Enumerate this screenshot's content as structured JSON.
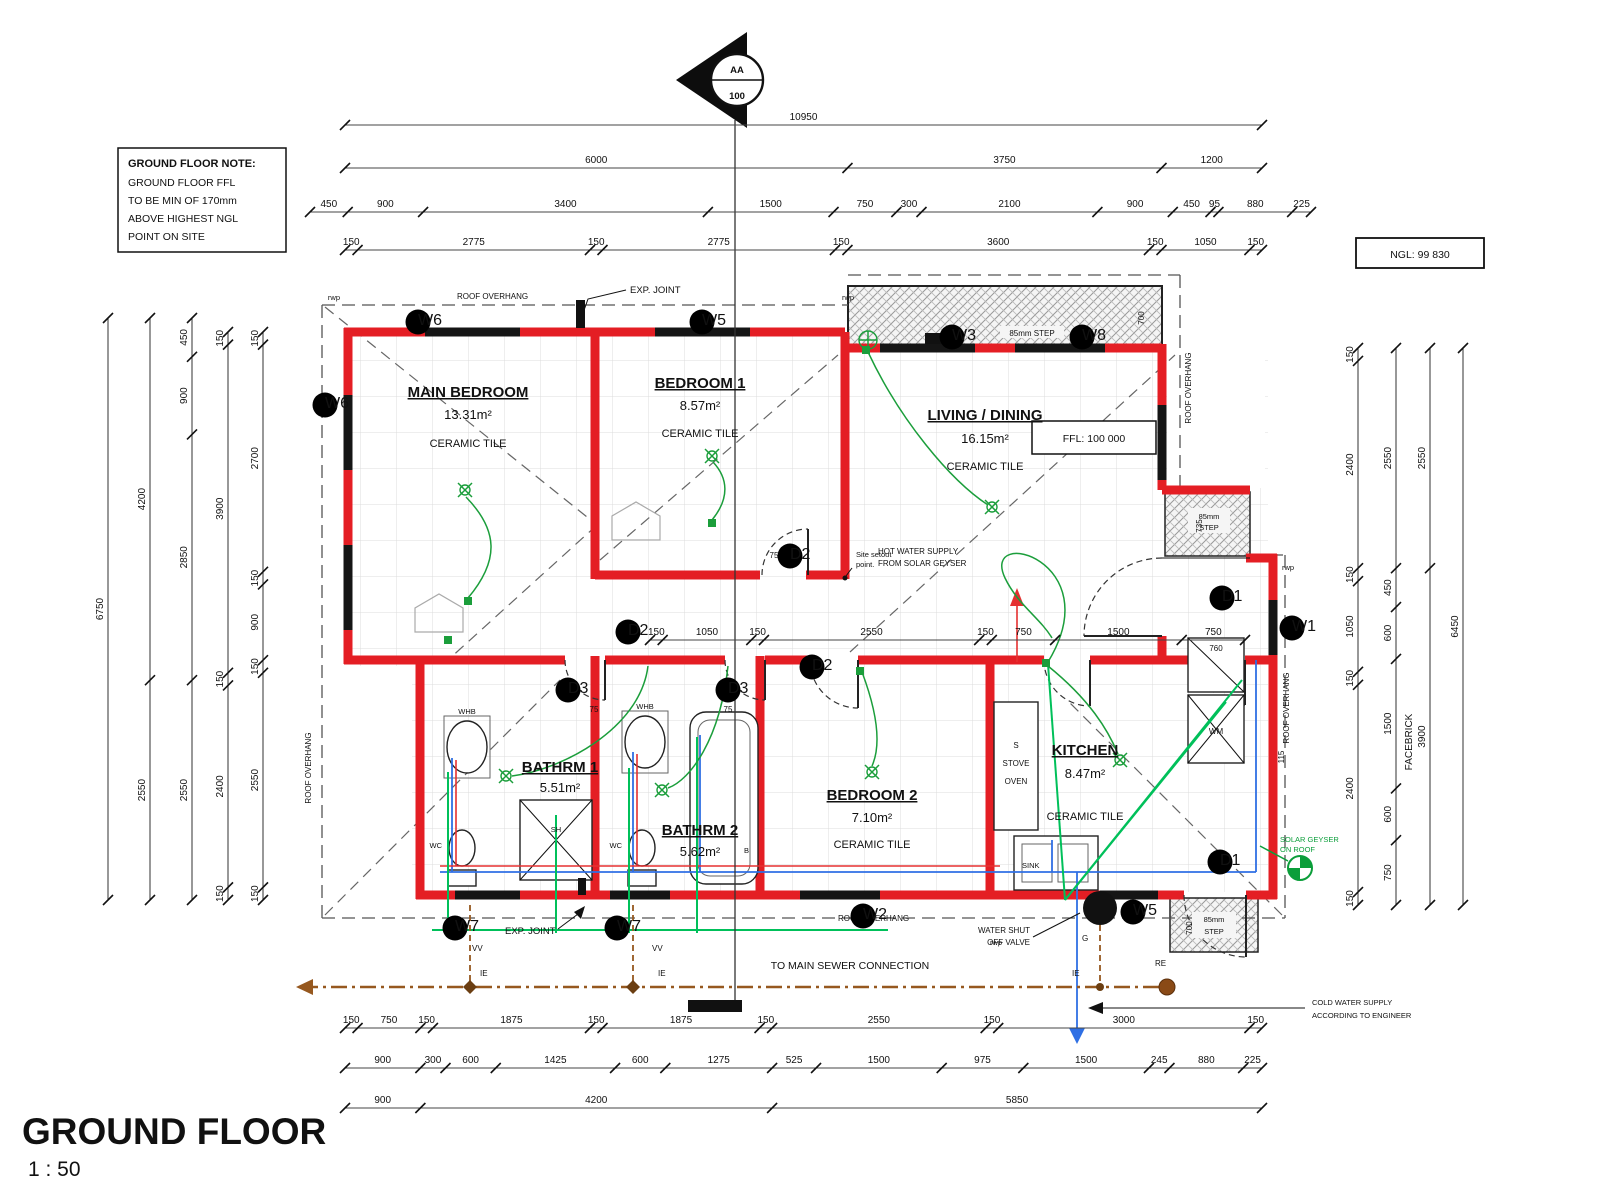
{
  "title": {
    "text": "GROUND FLOOR",
    "scale": "1 : 50"
  },
  "note": {
    "l1": "GROUND FLOOR NOTE:",
    "l2": "GROUND FLOOR FFL",
    "l3": "TO BE MIN OF 170mm",
    "l4": "ABOVE HIGHEST NGL",
    "l5": "POINT ON SITE"
  },
  "levels": {
    "ffl": "FFL: 100 000",
    "ngl": "NGL: 99 830"
  },
  "marker": {
    "top": "AA",
    "bottom": "100"
  },
  "rooms": [
    {
      "name": "MAIN BEDROOM",
      "area": "13.31m²",
      "finish": "CERAMIC TILE"
    },
    {
      "name": "BEDROOM 1",
      "area": "8.57m²",
      "finish": "CERAMIC TILE"
    },
    {
      "name": "LIVING / DINING",
      "area": "16.15m²",
      "finish": "CERAMIC TILE"
    },
    {
      "name": "BATHRM 1",
      "area": "5.51m²",
      "finish": ""
    },
    {
      "name": "BATHRM 2",
      "area": "5.62m²",
      "finish": ""
    },
    {
      "name": "BEDROOM 2",
      "area": "7.10m²",
      "finish": "CERAMIC TILE"
    },
    {
      "name": "KITCHEN",
      "area": "8.47m²",
      "finish": "CERAMIC TILE"
    }
  ],
  "dims": {
    "top1": [
      "10950"
    ],
    "top2": [
      "6000",
      "3750",
      "1200"
    ],
    "top3": [
      "450",
      "900",
      "3400",
      "1500",
      "750",
      "300",
      "2100",
      "900",
      "450",
      "95",
      "880",
      "225"
    ],
    "top4": [
      "150",
      "2775",
      "150",
      "2775",
      "150",
      "3600",
      "150",
      "1050",
      "150"
    ],
    "botA": [
      "150",
      "750",
      "150",
      "1875",
      "150",
      "1875",
      "150",
      "2550",
      "150",
      "3000",
      "150"
    ],
    "botB": [
      "900",
      "300",
      "600",
      "1425",
      "600",
      "1275",
      "525",
      "1500",
      "975",
      "1500",
      "245",
      "880",
      "225"
    ],
    "botC": [
      "900",
      "4200",
      "5850"
    ],
    "mid": [
      "150",
      "1050",
      "150",
      "2550",
      "150",
      "750",
      "1500",
      "750"
    ],
    "left1": [
      "6750"
    ],
    "left2": [
      "4200",
      "2550"
    ],
    "left3": [
      "450",
      "900",
      "2850",
      "2550"
    ],
    "left4": [
      "150",
      "3900",
      "150",
      "2400",
      "150"
    ],
    "left5": [
      "150",
      "2700",
      "150",
      "900",
      "150",
      "2550",
      "150"
    ],
    "right1": [
      "150",
      "2400",
      "150",
      "1050",
      "150",
      "2400",
      "150"
    ],
    "right2": [
      "2550",
      "450",
      "600",
      "1500",
      "600",
      "750"
    ],
    "right3": [
      "2550",
      "3900"
    ],
    "right4": [
      "6450"
    ]
  },
  "jdims": {
    "d75": "75",
    "d115": "115",
    "d760": "760",
    "d735": "735",
    "d700": "700"
  },
  "tags": {
    "w1": "W1",
    "w2": "W2",
    "w3": "W3",
    "w5": "W5",
    "w6": "W6",
    "w7": "W7",
    "w8": "W8",
    "d1": "D1",
    "d2": "D2",
    "d3": "D3"
  },
  "labels": {
    "roof_overhang": "ROOF OVERHANG",
    "exp_joint": "EXP. JOINT",
    "step": "85mm STEP",
    "step_a": "85mm",
    "step_b": "STEP",
    "sewer": "TO MAIN SEWER CONNECTION",
    "cold_a": "COLD WATER SUPPLY",
    "cold_b": "ACCORDING TO ENGINEER",
    "hot_a": "HOT WATER SUPPLY",
    "hot_b": "FROM SOLAR GEYSER",
    "geyser_a": "SOLAR GEYSER",
    "geyser_b": "ON ROOF",
    "shut_a": "WATER SHUT",
    "shut_b": "OFF VALVE",
    "setout_a": "Site setout",
    "setout_b": "point.",
    "facebrick": "FACEBRICK",
    "rwp": "rwp",
    "vv": "VV",
    "ie": "IE",
    "re": "RE",
    "g": "G",
    "sink": "SINK",
    "wm": "WM",
    "whb": "WHB",
    "wc": "WC",
    "sh": "SH",
    "b": "B",
    "s": "S",
    "stove": "STOVE",
    "oven": "OVEN"
  }
}
